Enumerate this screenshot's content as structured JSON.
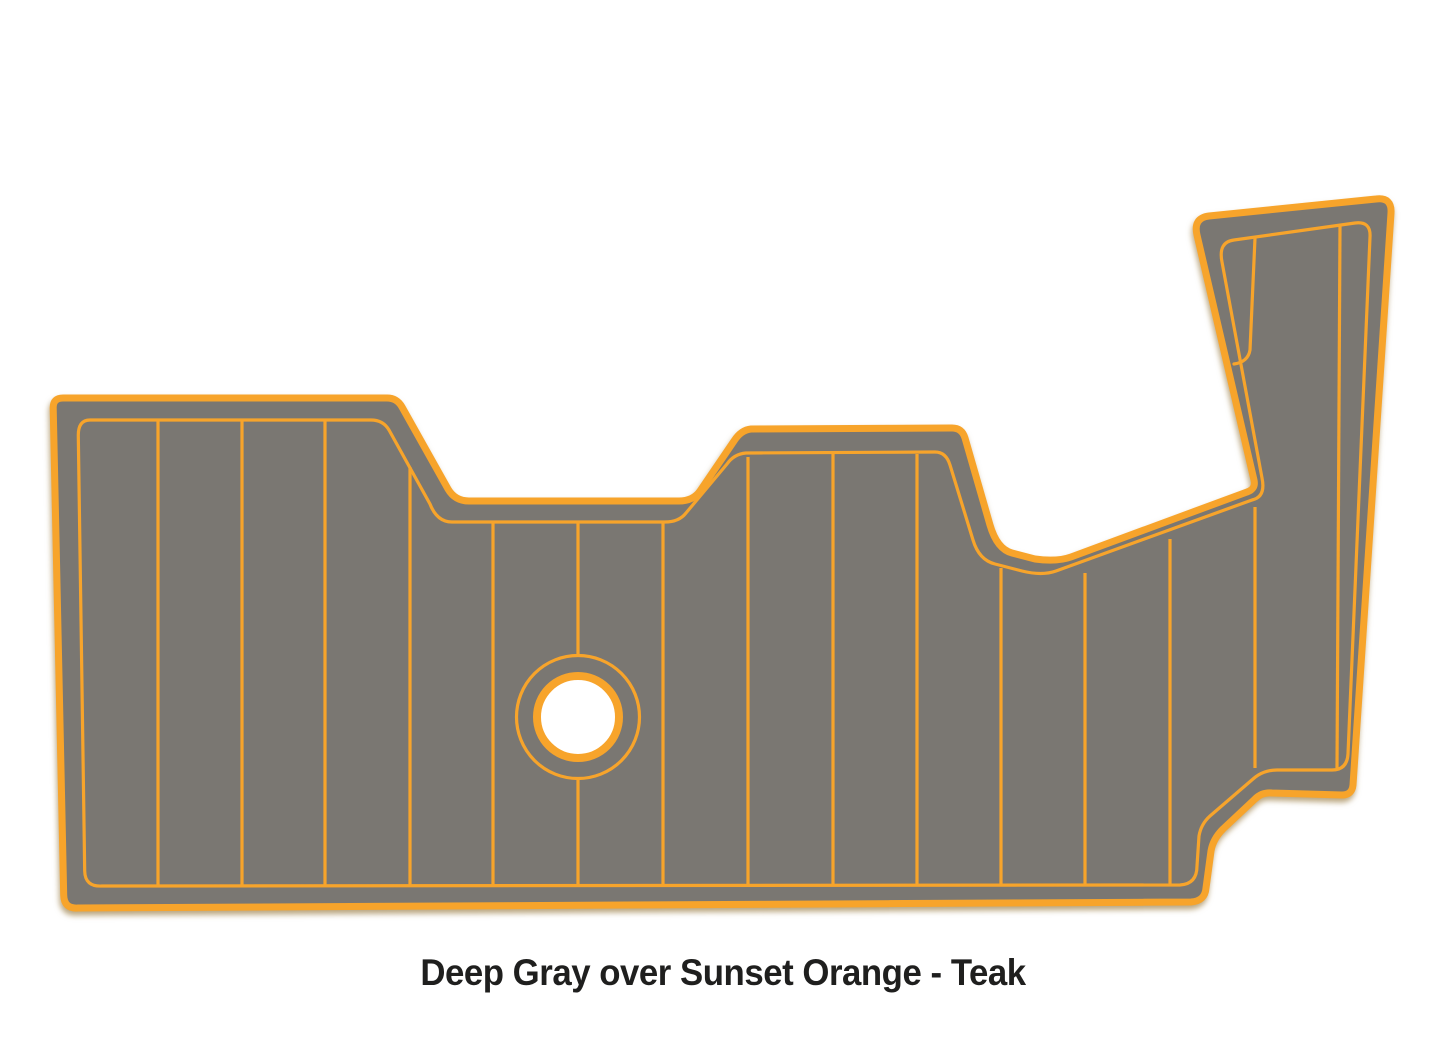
{
  "caption": {
    "text": "Deep Gray over Sunset Orange - Teak"
  },
  "product": {
    "primary_color_name": "Deep Gray",
    "accent_color_name": "Sunset Orange",
    "pattern_name": "Teak"
  },
  "colors": {
    "pad_gray": "#7A7772",
    "trim_orange": "#F7A42B",
    "caption_text": "#1F1F1E",
    "background": "#FFFFFF"
  }
}
